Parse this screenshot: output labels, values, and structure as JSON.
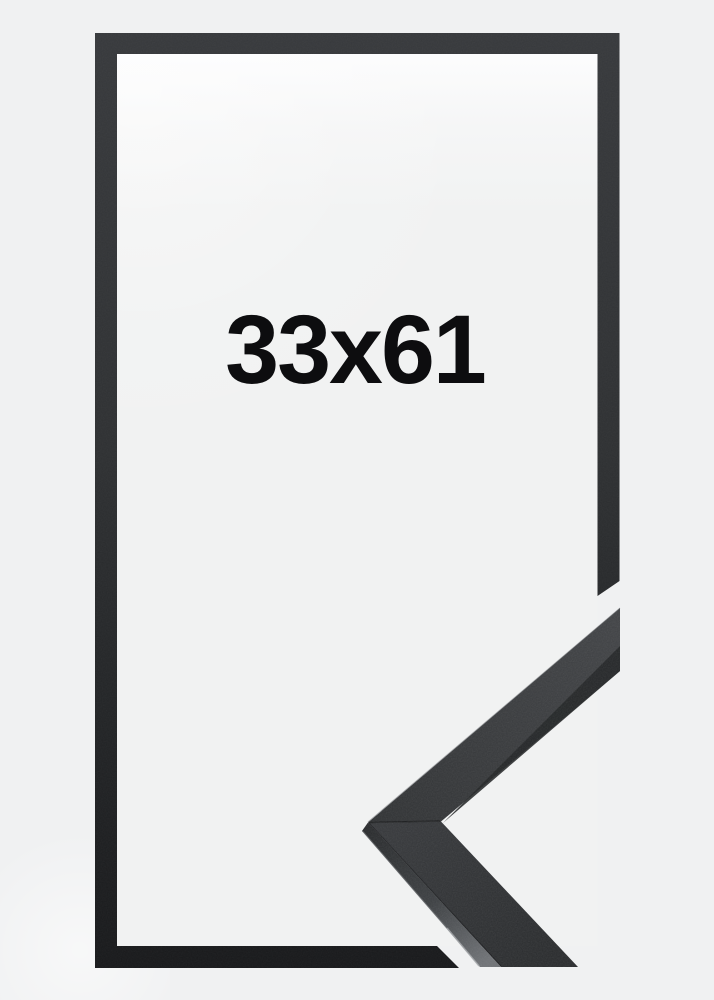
{
  "frame_product_image": {
    "size_label": "33x61",
    "description_labels": {
      "frame_outline": "thin black frame outline",
      "corner_sample": "close-up of black moulding mitered corner"
    },
    "colors": {
      "page_background": "#f0f1f2",
      "inner_area": "#f1f2f2",
      "inner_glow": "#fdfdfe",
      "frame_gradient_top": "#37393c",
      "frame_gradient_mid": "#2c2e30",
      "frame_gradient_bottom": "#18191b",
      "moulding_face_light": "#414346",
      "moulding_face_dark": "#292b2d",
      "moulding_side_highlight": "#6f7276",
      "size_label_color": "#0d0d0f"
    }
  }
}
